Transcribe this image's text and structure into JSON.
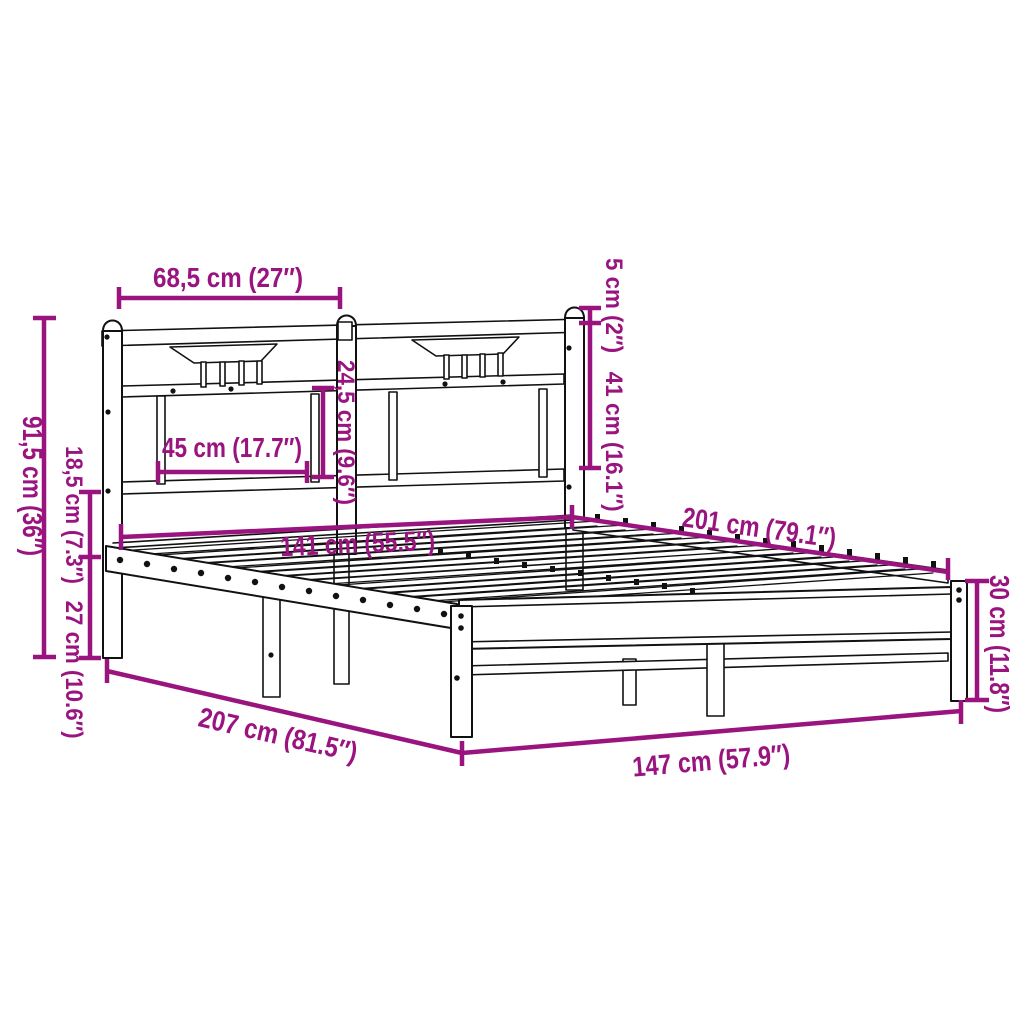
{
  "palette": {
    "accent": "#9A1480",
    "ink": "#111111",
    "background": "#FFFFFF"
  },
  "diagram": {
    "kind": "product-dimension-diagram",
    "subject": "metal-bed-frame-with-headboard",
    "units": [
      "cm",
      "inches"
    ]
  },
  "dims": [
    {
      "id": "headboard-section-width",
      "cm": 68.5,
      "inch": 27,
      "label": "68,5 cm (27″)"
    },
    {
      "id": "headboard-height",
      "cm": 91.5,
      "inch": 36,
      "label": "91,5 cm (36″)"
    },
    {
      "id": "under-bed-clearance",
      "cm": 18.5,
      "inch": 7.3,
      "label": "18,5 cm (7.3″)"
    },
    {
      "id": "platform-height",
      "cm": 27,
      "inch": 10.6,
      "label": "27 cm (10.6″)"
    },
    {
      "id": "headboard-panel-width",
      "cm": 45,
      "inch": 17.7,
      "label": "45 cm (17.7″)"
    },
    {
      "id": "headboard-panel-height",
      "cm": 24.5,
      "inch": 9.6,
      "label": "24,5 cm (9.6″)"
    },
    {
      "id": "post-top-height",
      "cm": 5,
      "inch": 2,
      "label": "5 cm (2″)"
    },
    {
      "id": "headboard-upper-height",
      "cm": 41,
      "inch": 16.1,
      "label": "41 cm (16.1″)"
    },
    {
      "id": "inner-width",
      "cm": 141,
      "inch": 55.5,
      "label": "141 cm (55.5″)"
    },
    {
      "id": "inner-length",
      "cm": 201,
      "inch": 79.1,
      "label": "201 cm (79.1″)"
    },
    {
      "id": "frame-height",
      "cm": 30,
      "inch": 11.8,
      "label": "30 cm (11.8″)"
    },
    {
      "id": "outer-width",
      "cm": 147,
      "inch": 57.9,
      "label": "147 cm (57.9″)"
    },
    {
      "id": "outer-length",
      "cm": 207,
      "inch": 81.5,
      "label": "207 cm (81.5″)"
    }
  ]
}
